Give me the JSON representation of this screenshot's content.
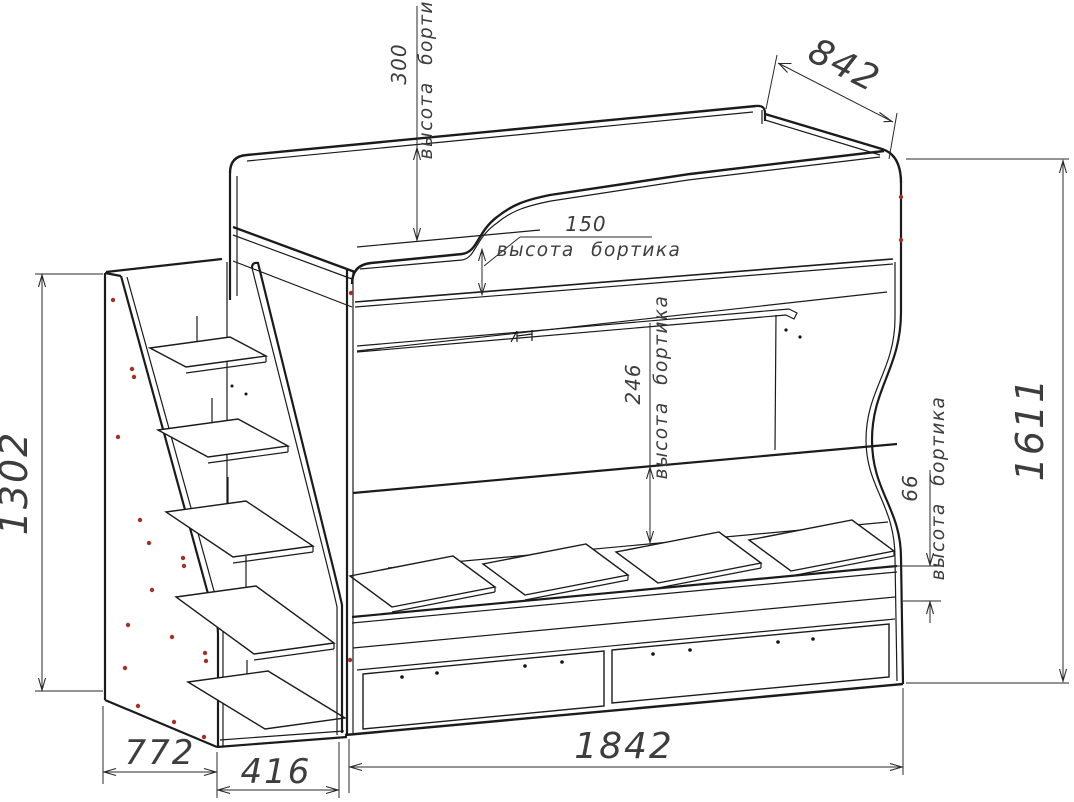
{
  "drawing": {
    "type": "furniture assembly technical drawing",
    "subject": "bunk bed with stair shelves and under-bed drawers",
    "colors": {
      "line": "#1b1b1b",
      "accent_dot": "#a03228",
      "background": "#ffffff"
    },
    "dimensions": {
      "left_height": "1302",
      "stair_depth": "772",
      "stair_width": "416",
      "bed_length": "1842",
      "bed_depth": "842",
      "right_height": "1611",
      "upper_back_rail_height": "300",
      "upper_front_rail_height": "150",
      "lower_back_rail_height": "246",
      "lower_front_rail_height": "66",
      "rail_label": "высота бортика"
    }
  }
}
